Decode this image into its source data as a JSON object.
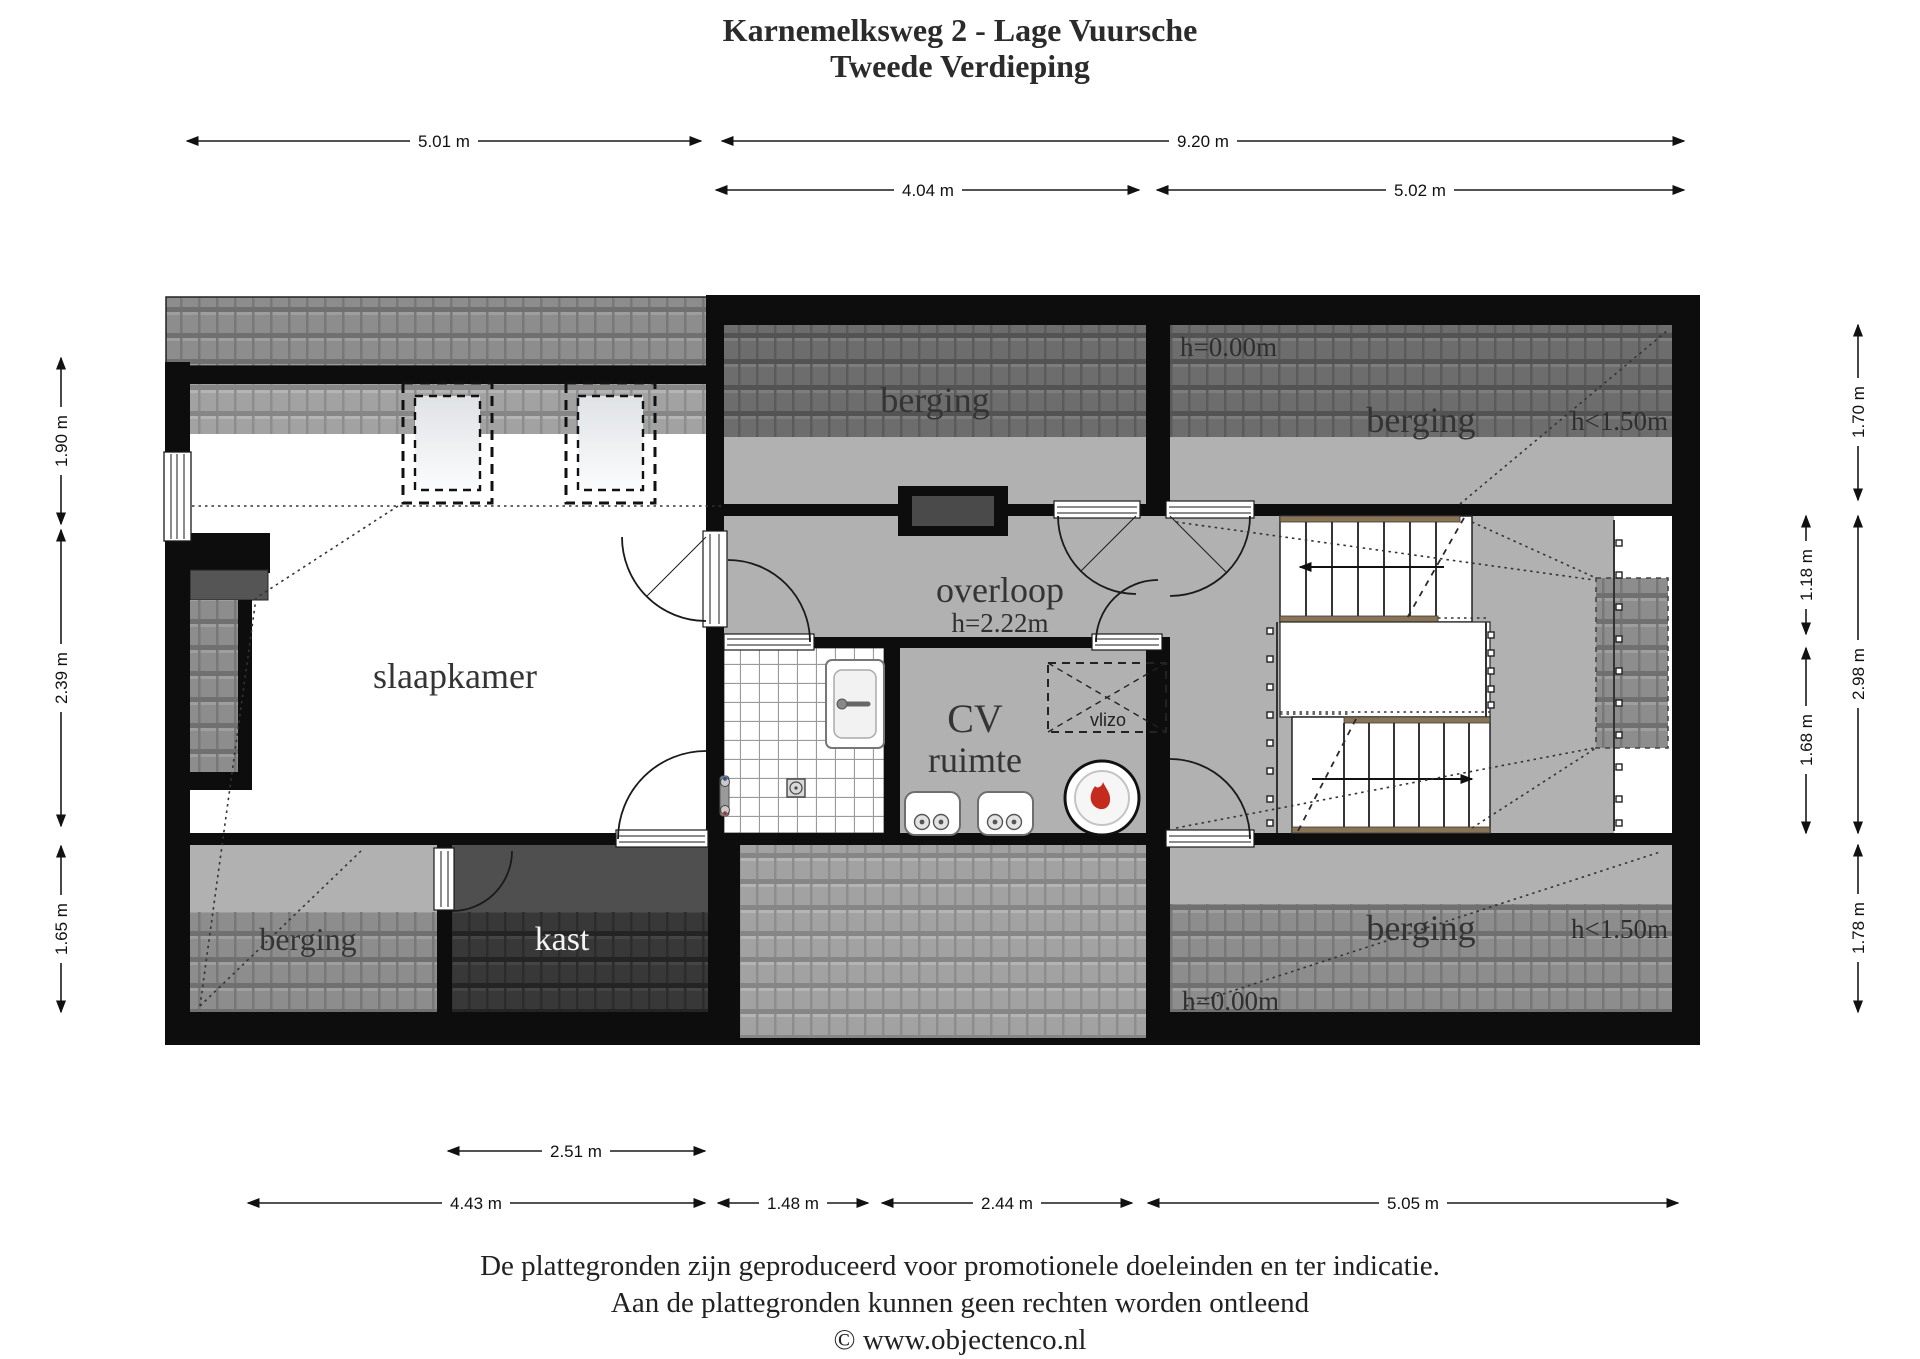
{
  "title": {
    "line1": "Karnemelksweg 2 - Lage Vuursche",
    "line2": "Tweede Verdieping"
  },
  "rooms": {
    "slaapkamer": "slaapkamer",
    "berging_top_middle": "berging",
    "berging_top_right": "berging",
    "berging_bottom_left": "berging",
    "berging_bottom_right": "berging",
    "kast": "kast",
    "overloop": "overloop",
    "cv_line1": "CV",
    "cv_line2": "ruimte",
    "vlizo": "vlizo"
  },
  "heights": {
    "overloop": "h=2.22m",
    "top_right_floor": "h=0.00m",
    "top_right_knee": "h<1.50m",
    "bottom_right_floor": "h=0.00m",
    "bottom_right_knee": "h<1.50m"
  },
  "dimensions": {
    "top_row1": [
      "5.01 m",
      "9.20 m"
    ],
    "top_row2": [
      "4.04 m",
      "5.02 m"
    ],
    "bottom_row1": [
      "2.51 m"
    ],
    "bottom_row2": [
      "4.43 m",
      "1.48 m",
      "2.44 m",
      "5.05 m"
    ],
    "left": [
      "1.90 m",
      "2.39 m",
      "1.65 m"
    ],
    "right_outer": [
      "1.70 m",
      "2.98 m",
      "1.78 m"
    ],
    "right_inner": [
      "1.18 m",
      "1.68 m"
    ]
  },
  "footer": {
    "line1": "De plattegronden zijn geproduceerd voor promotionele doeleinden en ter indicatie.",
    "line2": "Aan de plattegronden kunnen geen rechten worden ontleend",
    "line3": "© www.objectenco.nl"
  },
  "colors": {
    "wall": "#0d0d0d",
    "floor_gray": "#b1b1b1",
    "kast_floor": "#4f4f4f",
    "roof_light": "#a2a2a2",
    "roof_mid": "#8d8d8d",
    "roof_dark": "#6d6d6d",
    "roof_darkest": "#383838",
    "stair_nosing": "#8a7456",
    "boiler_flame": "#c42a1e"
  }
}
